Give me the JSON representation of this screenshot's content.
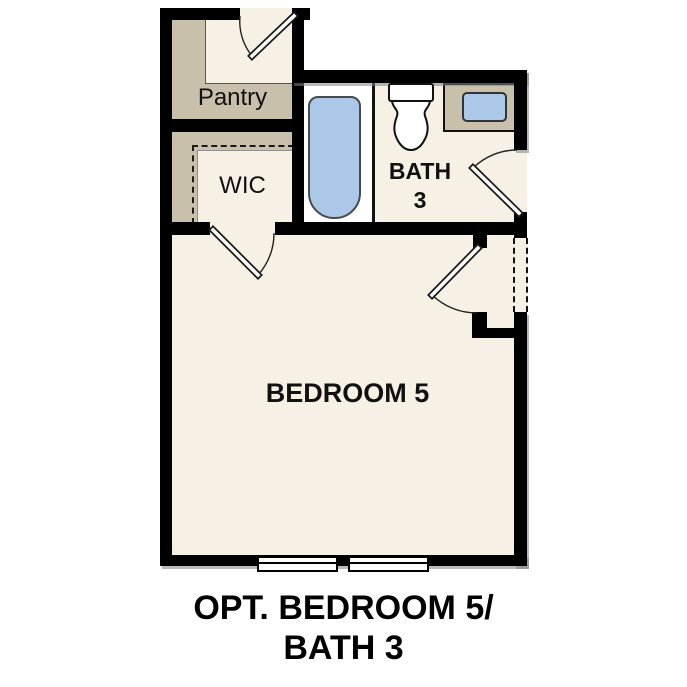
{
  "caption": {
    "line1": "OPT. BEDROOM 5/",
    "line2": "BATH 3"
  },
  "rooms": {
    "pantry": {
      "label": "Pantry"
    },
    "wic": {
      "label": "WIC"
    },
    "bath": {
      "label_line1": "BATH",
      "label_line2": "3"
    },
    "bedroom": {
      "label": "BEDROOM 5"
    }
  },
  "fixtures": [
    "bathtub",
    "toilet",
    "sink",
    "vanity",
    "window",
    "window"
  ],
  "doors": [
    "pantry-door",
    "wic-door",
    "bath-door",
    "bedroom-entry-door"
  ],
  "dashed_elements": [
    "wic-optional-outline",
    "right-wall-optional-opening"
  ],
  "colors": {
    "wall": "#000000",
    "floor": "#f7f0e4",
    "storage_tan": "#c9c0ab",
    "fixture_blue": "#abc8e8",
    "outline": "#222222",
    "shadow": "#999999",
    "background": "#ffffff",
    "text": "#111111"
  }
}
